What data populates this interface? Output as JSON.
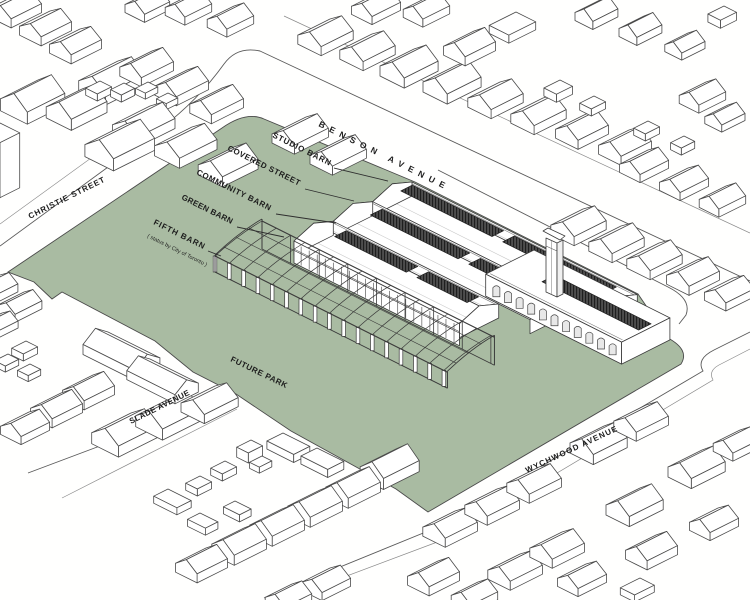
{
  "drawing": {
    "type": "site-axonometric",
    "park_label": "FUTURE PARK",
    "streets": {
      "benson": "BENSON AVENUE",
      "christie": "CHRISTIE STREET",
      "slade": "SLADE AVENUE",
      "wychwood": "WYCHWOOD AVENUE"
    },
    "barn_labels": {
      "studio": "STUDIO BARN",
      "covered": "COVERED STREET",
      "community": "COMMUNITY BARN",
      "green": "GREEN BARN",
      "fifth": "FIFTH BARN",
      "fifth_note": "( status by City of Toronto )"
    },
    "colors": {
      "park": "#a9bba2",
      "line": "#3a3a3a",
      "street_line": "#5a5a5a",
      "monitor_dark": "#4d4d4d",
      "monitor_hatch": "#1f1f1f",
      "building_fill": "#ffffff",
      "background": "#fffffe"
    }
  }
}
